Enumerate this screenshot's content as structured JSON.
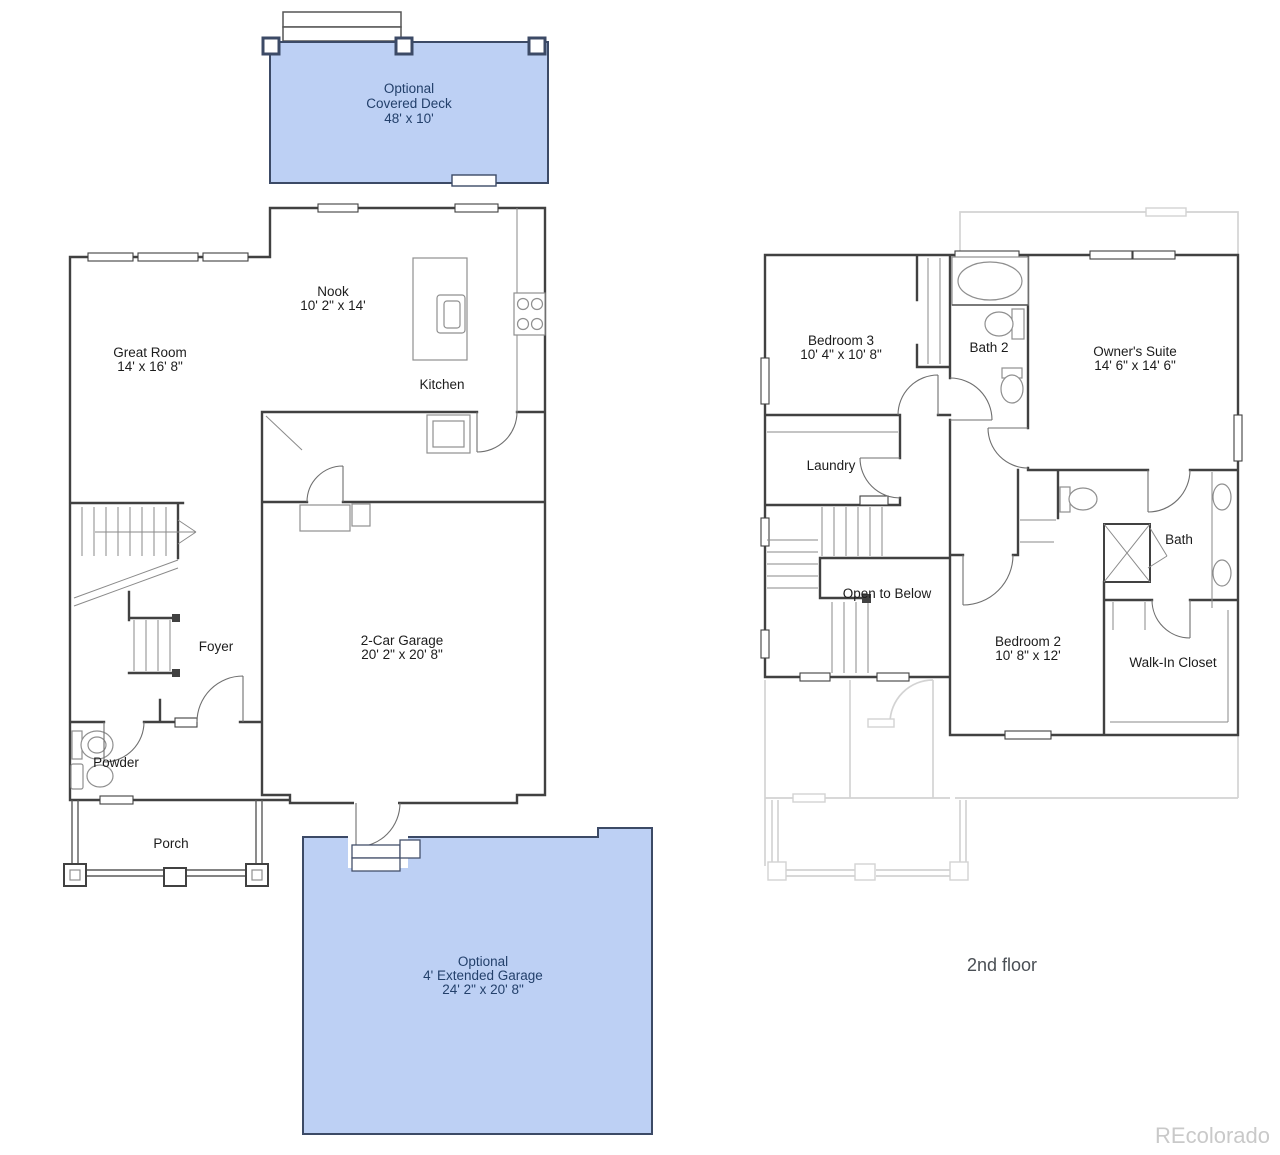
{
  "watermark": {
    "text": "REcolorado"
  },
  "colors": {
    "optional_area_fill": "#bdd0f4",
    "optional_area_border": "#3c4a66",
    "optional_text": "#23406b",
    "room_text": "#1c1c1c",
    "wall": "#414141",
    "ghost_outline": "#d3d3d3",
    "watermark_text": "#c9c9c9"
  },
  "first_floor": {
    "deck": {
      "line1": "Optional",
      "line2": "Covered Deck",
      "dims": "48' x 10'"
    },
    "great_room": {
      "name": "Great Room",
      "dims": "14' x 16' 8\""
    },
    "nook": {
      "name": "Nook",
      "dims": "10' 2\" x 14'"
    },
    "kitchen": {
      "name": "Kitchen"
    },
    "foyer": {
      "name": "Foyer"
    },
    "garage": {
      "name": "2-Car Garage",
      "dims": "20' 2\" x 20' 8\""
    },
    "powder": {
      "name": "Powder"
    },
    "porch": {
      "name": "Porch"
    },
    "extended_garage": {
      "line1": "Optional",
      "line2": "4' Extended Garage",
      "dims": "24' 2\" x 20' 8\""
    }
  },
  "second_floor": {
    "label": "2nd floor",
    "bedroom3": {
      "name": "Bedroom 3",
      "dims": "10' 4\" x 10' 8\""
    },
    "bath2": {
      "name": "Bath 2"
    },
    "owners_suite": {
      "name": "Owner's Suite",
      "dims": "14' 6\" x 14' 6\""
    },
    "laundry": {
      "name": "Laundry"
    },
    "open_to_below": {
      "name": "Open to Below"
    },
    "bedroom2": {
      "name": "Bedroom 2",
      "dims": "10' 8\" x 12'"
    },
    "bath": {
      "name": "Bath"
    },
    "walk_in_closet": {
      "name": "Walk-In Closet"
    }
  }
}
